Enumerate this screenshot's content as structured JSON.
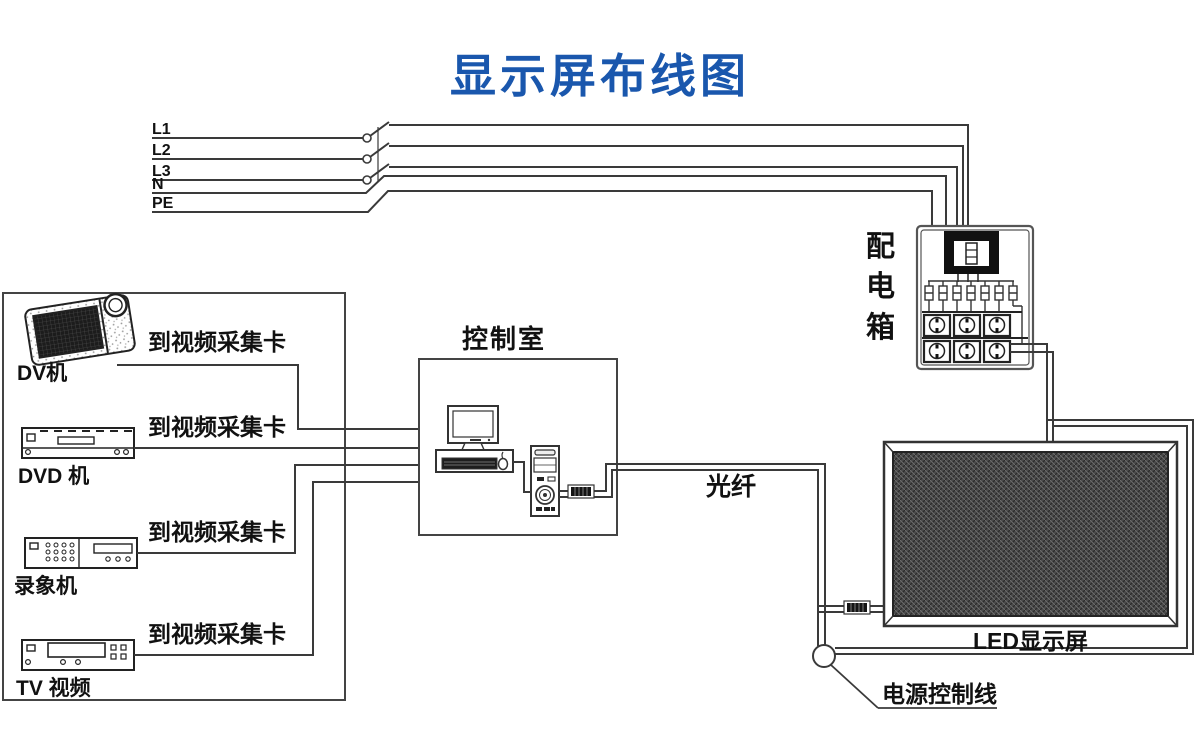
{
  "title": "显示屏布线图",
  "colors": {
    "title": "#1a57ad",
    "line": "#3a3a3a",
    "panel": "#4a4a4a"
  },
  "power_lines": {
    "labels": [
      "L1",
      "L2",
      "L3",
      "N",
      "PE"
    ]
  },
  "left_devices": {
    "capture_label": "到视频采集卡",
    "items": [
      {
        "name": "DV机"
      },
      {
        "name": "DVD 机"
      },
      {
        "name": "录象机"
      },
      {
        "name": "TV 视频"
      }
    ]
  },
  "control_room": {
    "label": "控制室"
  },
  "fiber": {
    "label": "光纤"
  },
  "distribution_box": {
    "chars": [
      "配",
      "电",
      "箱"
    ]
  },
  "led_screen": {
    "label": "LED显示屏"
  },
  "power_control": {
    "label": "电源控制线"
  }
}
